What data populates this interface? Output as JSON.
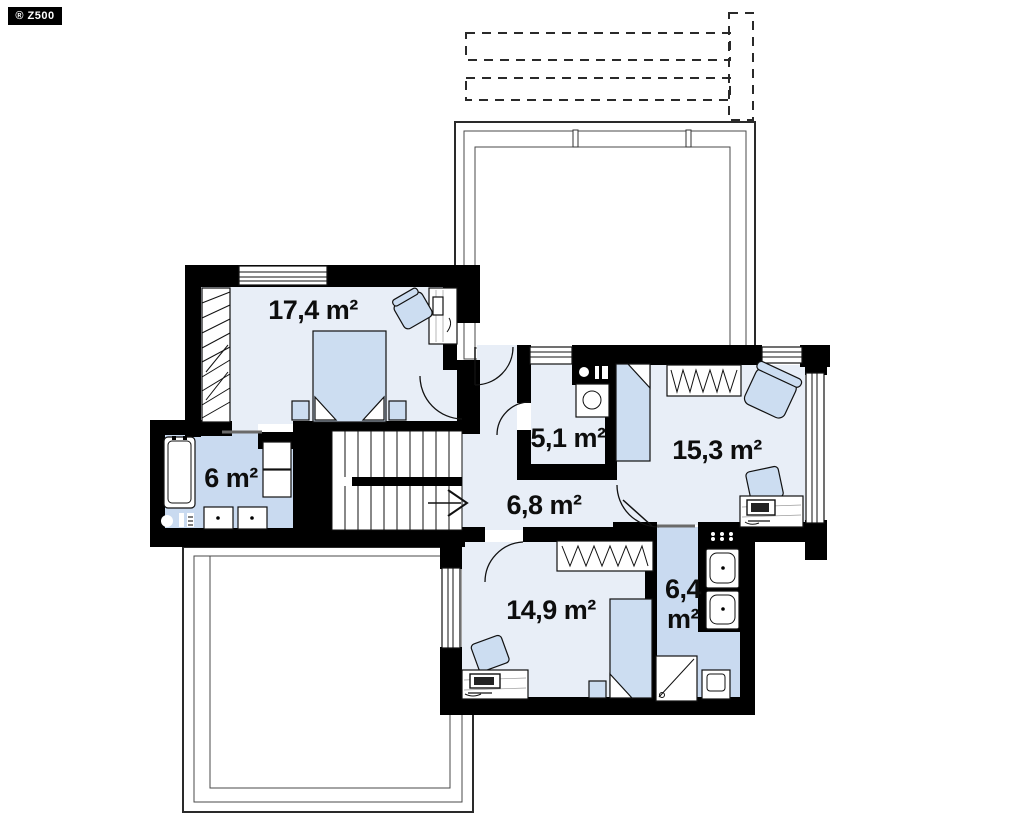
{
  "meta": {
    "brand_badge": "® Z500"
  },
  "colors": {
    "wall": "#000000",
    "room_fill": "#e8eef7",
    "bathroom_fill": "#c9daf0",
    "furniture_fill": "#ccddf1",
    "background": "#ffffff"
  },
  "plan": {
    "unit": "m²",
    "rooms": [
      {
        "id": "bedroom-top-left",
        "area": "17,4 m²"
      },
      {
        "id": "utility-room",
        "area": "5,1 m²"
      },
      {
        "id": "bedroom-right",
        "area": "15,3 m²"
      },
      {
        "id": "bathroom-left",
        "area": "6 m²"
      },
      {
        "id": "hall",
        "area": "6,8 m²"
      },
      {
        "id": "bedroom-bottom",
        "area": "14,9 m²"
      },
      {
        "id": "bathroom-right",
        "area_line1": "6,4",
        "area_line2": "m²"
      }
    ]
  }
}
